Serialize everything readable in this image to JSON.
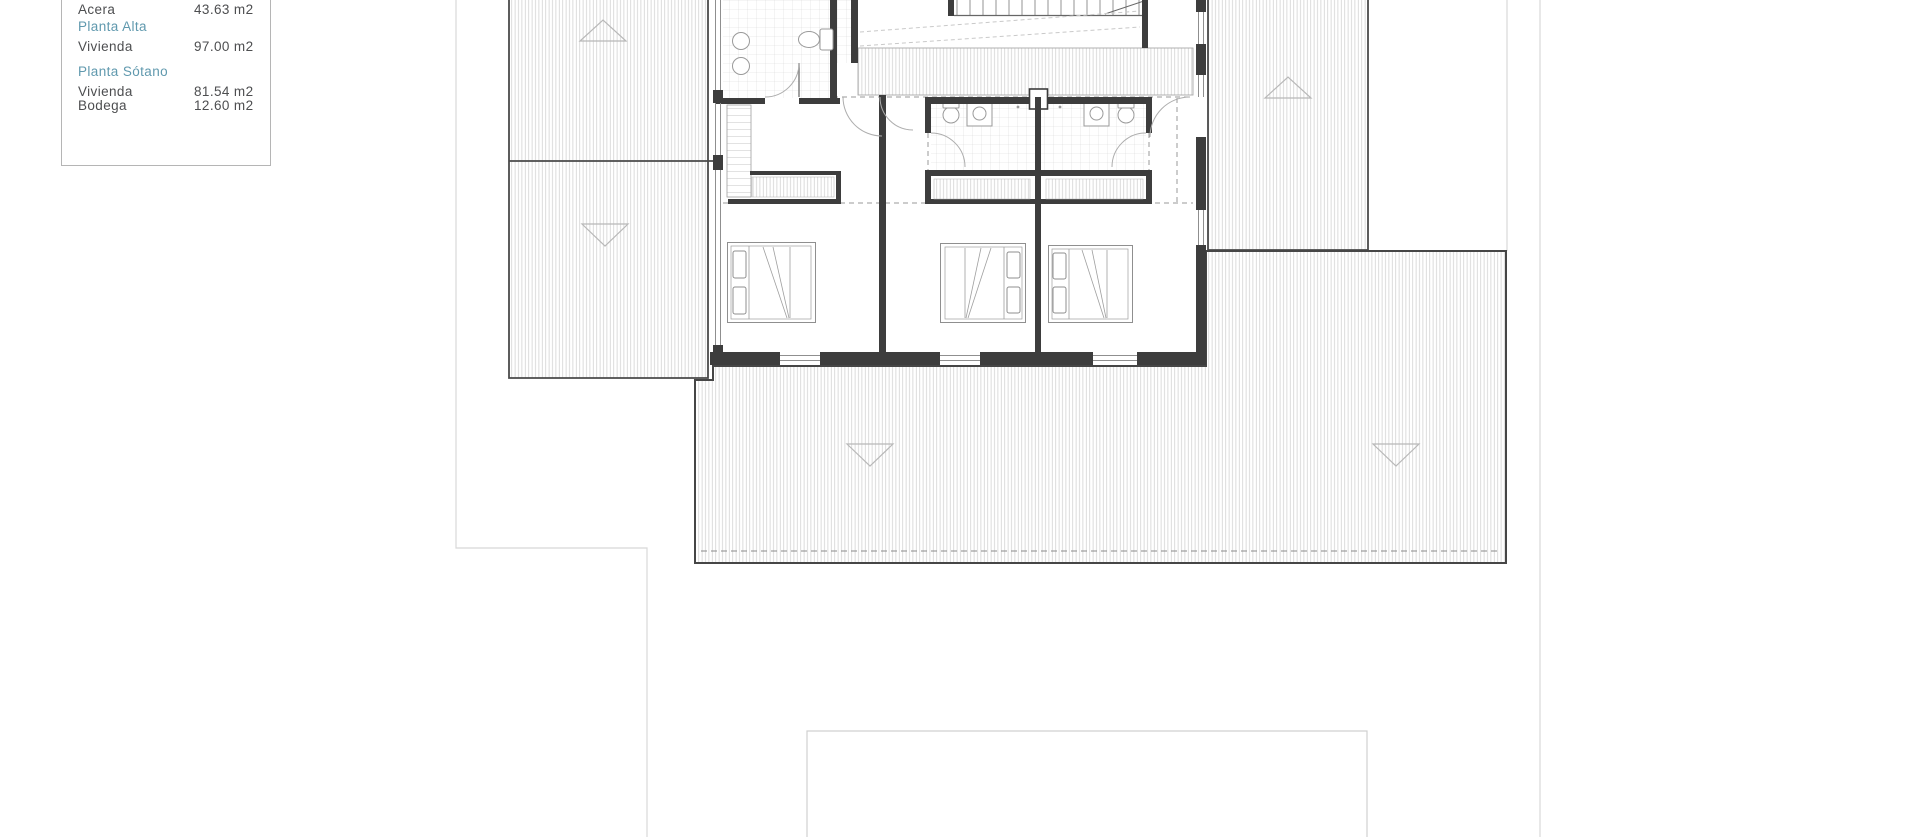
{
  "legend": {
    "rows": [
      {
        "label": "Acera",
        "value": "43.63 m2",
        "type": "data"
      },
      {
        "label": "Planta Alta",
        "value": "",
        "type": "section"
      },
      {
        "label": "Vivienda",
        "value": "97.00 m2",
        "type": "data"
      },
      {
        "label": "Planta Sótano",
        "value": "",
        "type": "section"
      },
      {
        "label": "Vivienda",
        "value": "81.54 m2",
        "type": "data"
      },
      {
        "label": "Bodega",
        "value": "12.60 m2",
        "type": "data"
      }
    ],
    "colors": {
      "section_text": "#6099ae",
      "label_text": "#4d4e50",
      "border": "#b5b5b5"
    }
  },
  "plan": {
    "type": "architectural-floor-plan",
    "floor_shown": "Planta Alta",
    "colors": {
      "wall": "#3d3d3d",
      "hatch": "#cdcdcd",
      "tile": "#d8d8d8",
      "fixture": "#9a9a9a",
      "boundary": "#d8d8d8",
      "slope_arrow": "#b8b8b8"
    },
    "features": [
      "roof-terrace-upper-left",
      "roof-terrace-lower-left",
      "roof-terrace-right",
      "terrace-south",
      "pool-outline",
      "staircase",
      "bathroom-main",
      "bathroom-ensuite-left",
      "bathroom-ensuite-right",
      "bedroom-1",
      "bedroom-2",
      "bedroom-3",
      "deck-band",
      "property-boundary"
    ]
  }
}
